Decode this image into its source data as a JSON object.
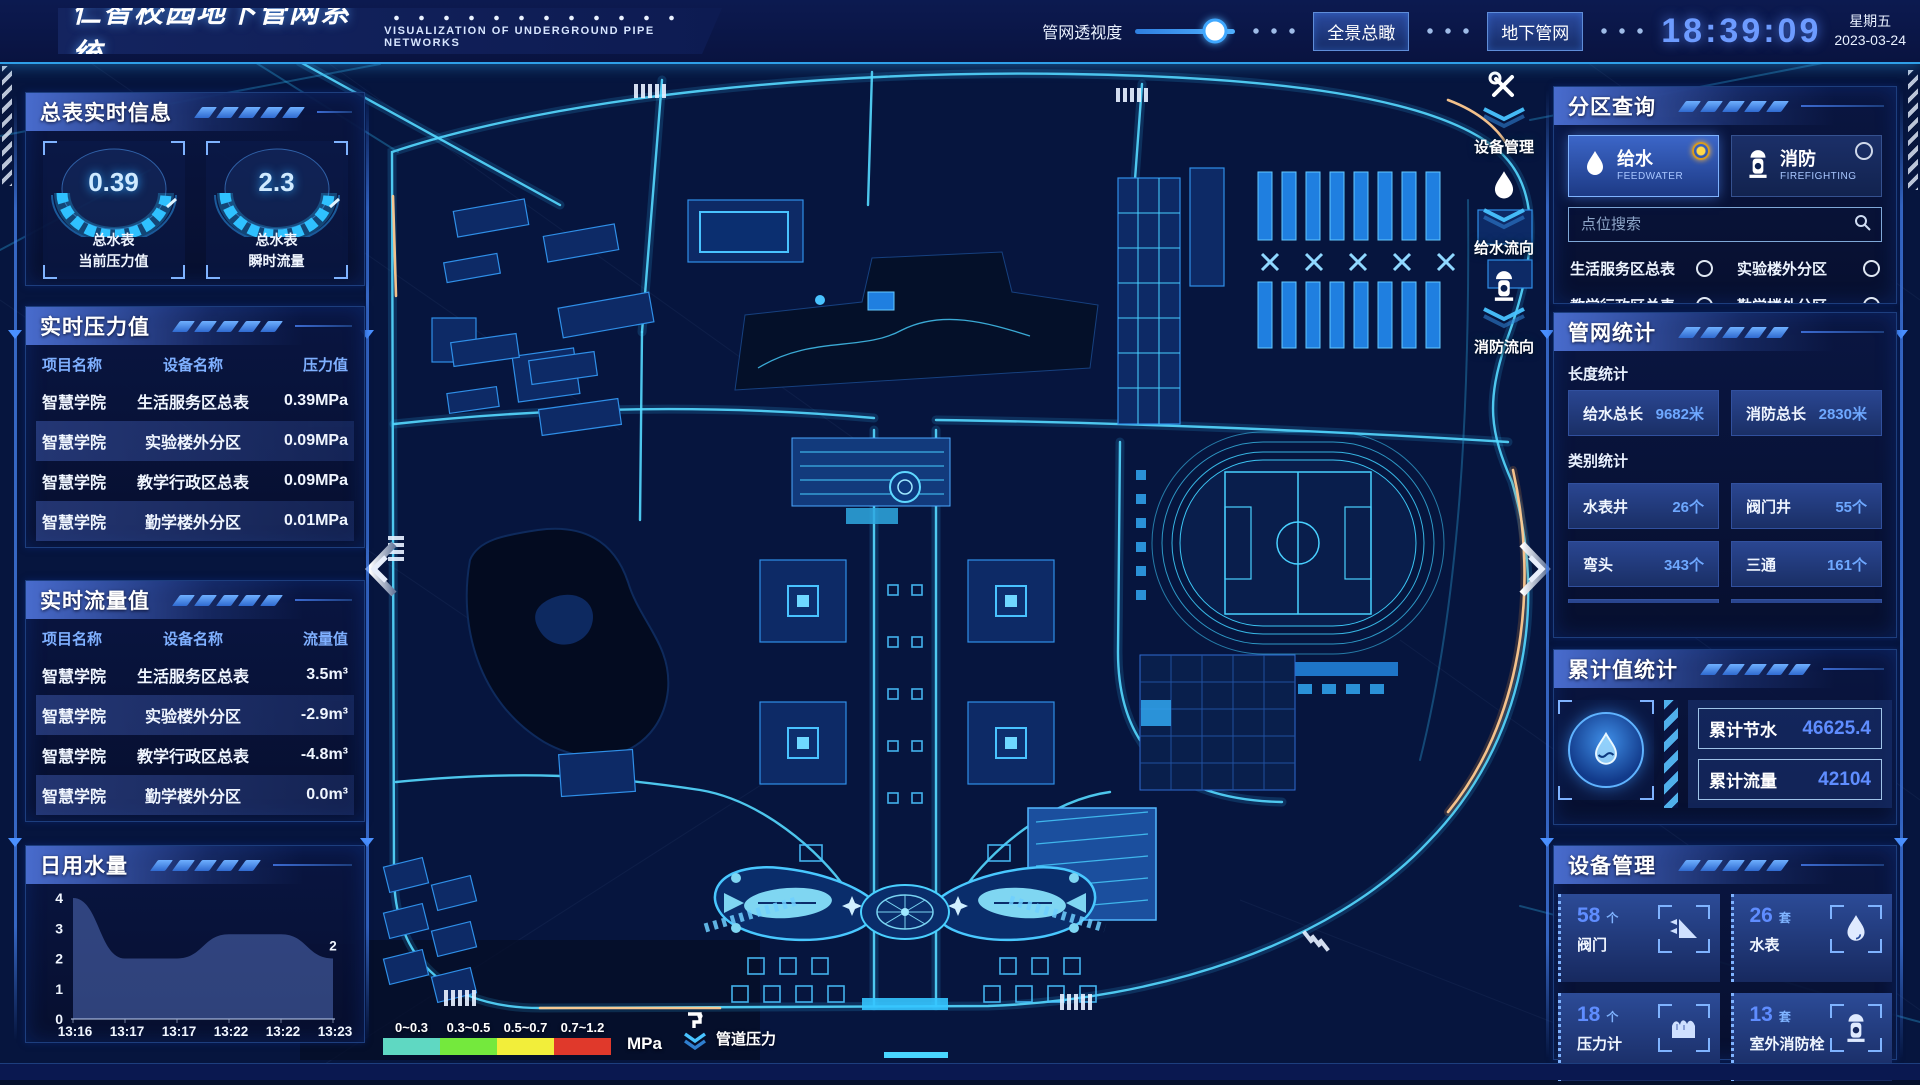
{
  "header": {
    "title": "仁智校园地下管网系统",
    "subtitle": "VISUALIZATION OF UNDERGROUND PIPE NETWORKS",
    "opacity_label": "管网透视度",
    "overview_button": "全景总瞰",
    "underground_button": "地下管网",
    "time": "18:39:09",
    "weekday": "星期五",
    "date": "2023-03-24"
  },
  "left": {
    "meter": {
      "title": "总表实时信息",
      "gauges": [
        {
          "value": "0.39",
          "line1": "总水表",
          "line2": "当前压力值"
        },
        {
          "value": "2.3",
          "line1": "总水表",
          "line2": "瞬时流量"
        }
      ]
    },
    "pressure": {
      "title": "实时压力值",
      "headers": [
        "项目名称",
        "设备名称",
        "压力值"
      ],
      "rows": [
        [
          "智慧学院",
          "生活服务区总表",
          "0.39MPa"
        ],
        [
          "智慧学院",
          "实验楼外分区",
          "0.09MPa"
        ],
        [
          "智慧学院",
          "教学行政区总表",
          "0.09MPa"
        ],
        [
          "智慧学院",
          "勤学楼外分区",
          "0.01MPa"
        ],
        [
          "智慧学院",
          "砺学楼外分区",
          "0.00MPa"
        ]
      ]
    },
    "flow": {
      "title": "实时流量值",
      "headers": [
        "项目名称",
        "设备名称",
        "流量值"
      ],
      "rows": [
        [
          "智慧学院",
          "生活服务区总表",
          "3.5m³"
        ],
        [
          "智慧学院",
          "实验楼外分区",
          "-2.9m³"
        ],
        [
          "智慧学院",
          "教学行政区总表",
          "-4.8m³"
        ],
        [
          "智慧学院",
          "勤学楼外分区",
          "0.0m³"
        ],
        [
          "智慧学院",
          "砺学楼外分区",
          "2.3m³"
        ]
      ]
    },
    "daily": {
      "title": "日用水量"
    }
  },
  "right": {
    "zone": {
      "title": "分区查询",
      "feedwater": {
        "label": "给水",
        "sub": "FEEDWATER"
      },
      "firefighting": {
        "label": "消防",
        "sub": "FIREFIGHTING"
      },
      "search_placeholder": "点位搜索",
      "items": [
        "生活服务区总表",
        "实验楼外分区",
        "教学行政区总表",
        "勤学楼外分区",
        "砺学楼外分区",
        "宿舍区泵房"
      ]
    },
    "network": {
      "title": "管网统计",
      "length_label": "长度统计",
      "category_label": "类别统计",
      "stats": [
        {
          "label": "给水总长",
          "value": "9682米"
        },
        {
          "label": "消防总长",
          "value": "2830米"
        }
      ],
      "categories": [
        {
          "label": "水表井",
          "value": "26个"
        },
        {
          "label": "阀门井",
          "value": "55个"
        },
        {
          "label": "弯头",
          "value": "343个"
        },
        {
          "label": "三通",
          "value": "161个"
        }
      ]
    },
    "totals": {
      "title": "累计值统计",
      "rows": [
        {
          "label": "累计节水",
          "value": "46625.4"
        },
        {
          "label": "累计流量",
          "value": "42104"
        }
      ]
    },
    "devices": {
      "title": "设备管理",
      "cards": [
        {
          "count": "58",
          "unit": "个",
          "name": "阀门",
          "icon": "valve-icon"
        },
        {
          "count": "26",
          "unit": "套",
          "name": "水表",
          "icon": "water-meter-icon"
        },
        {
          "count": "18",
          "unit": "个",
          "name": "压力计",
          "icon": "pressure-gauge-icon"
        },
        {
          "count": "13",
          "unit": "套",
          "name": "室外消防栓",
          "icon": "hydrant-icon"
        }
      ]
    }
  },
  "map": {
    "overlays": [
      "设备管理",
      "给水流向",
      "消防流向"
    ],
    "legend": {
      "unit": "MPa",
      "label": "管道压力",
      "ranges": [
        {
          "label": "0~0.3",
          "color": "#5fd8c2"
        },
        {
          "label": "0.3~0.5",
          "color": "#74e93d"
        },
        {
          "label": "0.5~0.7",
          "color": "#f2ee3a"
        },
        {
          "label": "0.7~1.2",
          "color": "#e0392b"
        }
      ]
    }
  },
  "chart_data": {
    "type": "area",
    "title": "日用水量",
    "x": [
      "13:16",
      "13:17",
      "13:17",
      "13:22",
      "13:22",
      "13:23"
    ],
    "values": [
      4,
      2,
      2,
      2.8,
      2.8,
      2
    ],
    "ylim": [
      0,
      4
    ],
    "yticks": [
      0,
      1,
      2,
      3,
      4
    ],
    "end_label": "2",
    "end_label_color": "#d8b43c",
    "area_color": "#3d5a9e",
    "xlabel": "",
    "ylabel": ""
  }
}
